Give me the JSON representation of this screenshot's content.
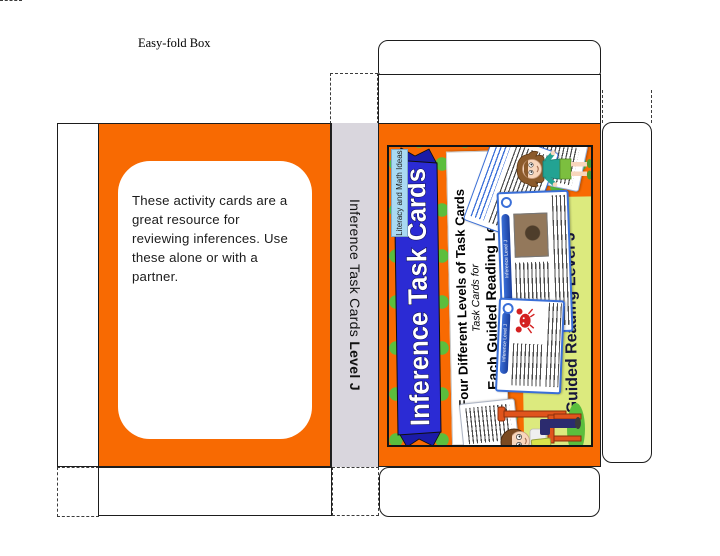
{
  "page": {
    "title": "Easy-fold Box"
  },
  "back_panel": {
    "note": "These activity cards are a great resource for reviewing inferences. Use these alone or with a partner.",
    "lines": [
      "These activity cards are a",
      "great resource for",
      "reviewing inferences. Use",
      "these alone or with a",
      "partner."
    ]
  },
  "spine": {
    "title": "Inference Task Cards",
    "level": "Level J"
  },
  "cover": {
    "brand_tag": "Literacy and Math Ideas",
    "ribbon_title": "Inference Task Cards",
    "banner": {
      "line1": "Four Different Levels of Task Cards",
      "line2": "Task Cards for",
      "line3_underlined": "Each",
      "line3_rest": " Guided Reading Level"
    },
    "lexile_box": {
      "line1": "Lexiles 350- 430",
      "line2": "Guided Reading Level J"
    },
    "sample_card_label": "Inference Level J",
    "colors": {
      "panel_orange": "#F86A02",
      "dot_green": "#5BBE3D",
      "ribbon_blue": "#2B2BD4",
      "ribbon_fold_blue": "#1B1BA8",
      "spine_gray": "#D9D6DD",
      "lexile_green": "#DCEA7E",
      "brand_tag_blue": "#A9D9F2",
      "card_border_blue": "#3A6FD8"
    }
  }
}
